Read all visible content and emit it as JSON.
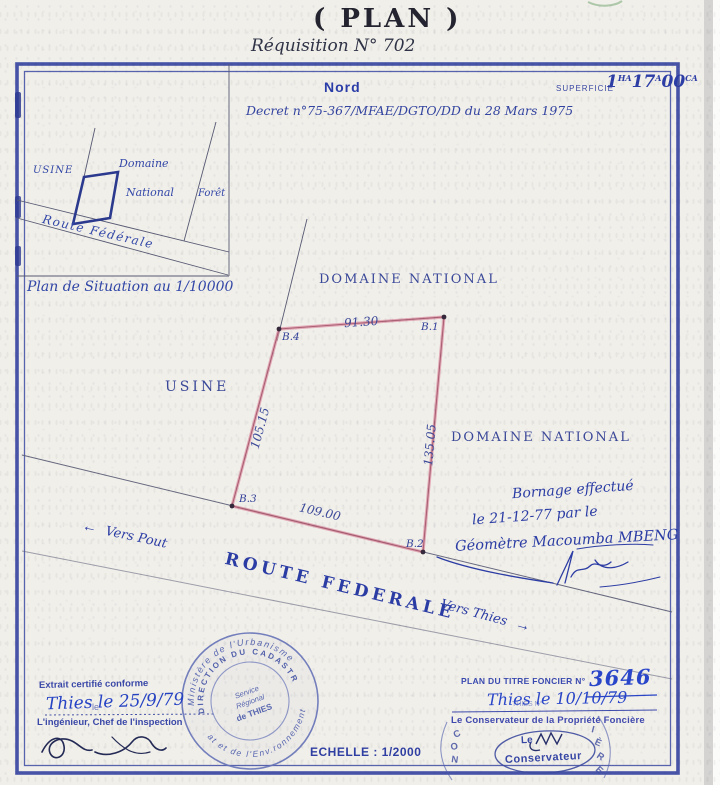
{
  "page": {
    "title": "( PLAN )",
    "requisition": "Réquisition N° 702"
  },
  "header": {
    "nord": "Nord",
    "superficie_label": "SUPERFICIE",
    "sup": {
      "v1": "1",
      "u1": "HA",
      "v2": "17",
      "u2": "A",
      "v3": "00",
      "u3": "CA"
    },
    "decree": "Decret n°75-367/MFAE/DGTO/DD du 28 Mars 1975"
  },
  "inset": {
    "caption": "Plan de Situation au 1/10000",
    "usine": "USINE",
    "domaine": "Domaine",
    "national": "National",
    "foret": "Forêt",
    "route": "Route Fédérale"
  },
  "plan": {
    "domaine_top": "DOMAINE NATIONAL",
    "domaine_right": "DOMAINE NATIONAL",
    "usine": "USINE",
    "route": "ROUTE FEDERALE",
    "vers_pout": "Vers Pout",
    "vers_thies": "Vers Thies",
    "arrow_left": "←",
    "arrow_right": "→",
    "b1": "B.1",
    "b2": "B.2",
    "b3": "B.3",
    "b4": "B.4",
    "len_top": "91.30",
    "len_left": "105.15",
    "len_right": "135.05",
    "len_bottom": "109.00",
    "bornage1": "Bornage effectué",
    "bornage2": "le 21-12-77 par le",
    "bornage3": "Géomètre Macoumba MBENG"
  },
  "certif": {
    "extrait": "Extrait certifié conforme",
    "date": "Thies le 25/9/79",
    "le_printed": "le",
    "engineer": "L'ingénieur, Chef de l'inspection"
  },
  "stamp": {
    "top": "Ministère de l'Urbanisme",
    "bottom": "at et de l'Env.ronnement",
    "inner": "DIRECTION DU CADASTRE",
    "c1": "Service",
    "c2": "Régional",
    "c3": "de THIES"
  },
  "titre": {
    "label": "PLAN DU TITRE FONCIER N°",
    "number": "3646",
    "date": "Thies le 10/10/79",
    "printed_under": "THIES N°",
    "conservateur": "Le Conservateur de la Propriété Foncière",
    "oval_le": "Le",
    "oval_name": "Conservateur",
    "rl1": "C",
    "rl2": "O",
    "rl3": "N",
    "rr1": "I",
    "rr2": "È",
    "rr3": "R",
    "rr4": "E"
  },
  "scale": {
    "text": "ECHELLE : 1/2000"
  },
  "colors": {
    "frame_blue": "#3c4aa2",
    "printed_ink": "#3947a3",
    "handwriting_blue": "#2c3da5",
    "bright_pen_blue": "#2946ca",
    "parcel_pink": "#dc93a6",
    "parcel_core": "#a4576a",
    "survey_line": "#565a74",
    "stamp_blue": "#6673b8",
    "paper": "#f1efe9"
  }
}
